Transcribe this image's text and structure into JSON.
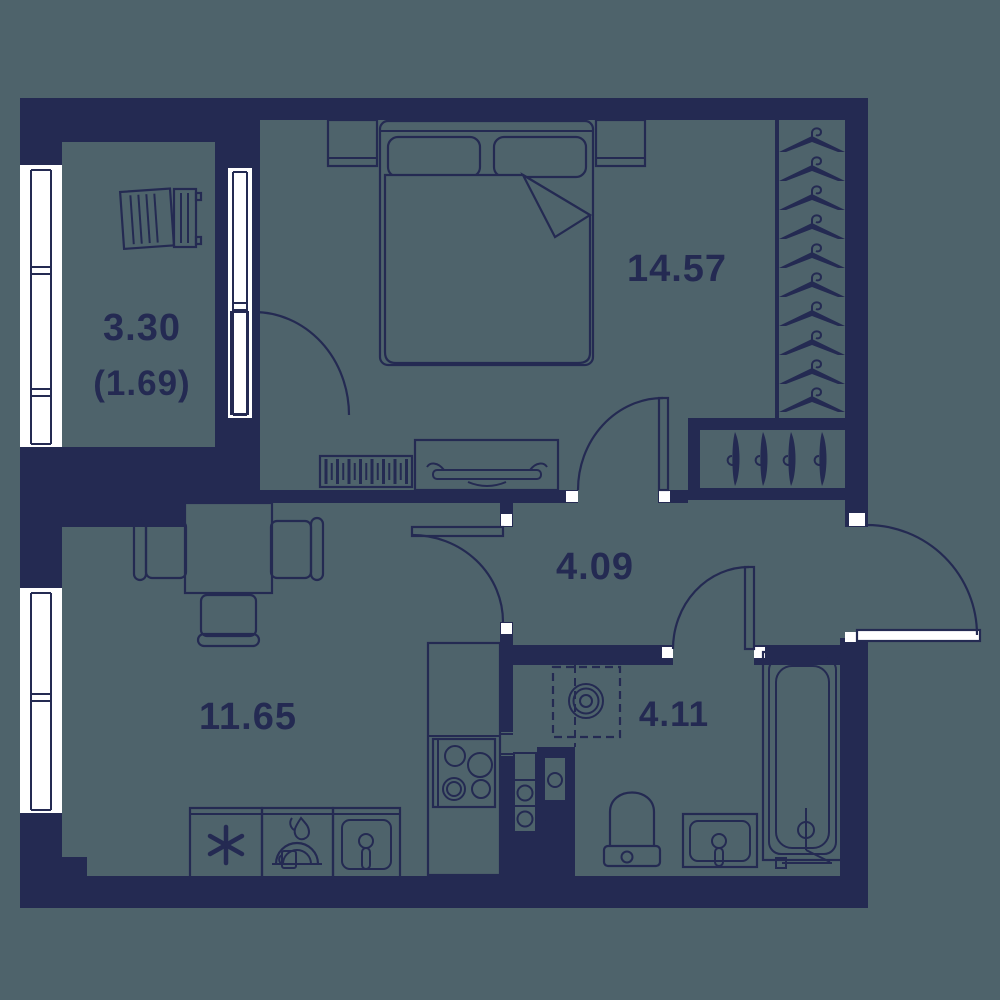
{
  "title": "apartment-floor-plan",
  "rooms": {
    "bedroom": {
      "name": "bedroom",
      "area": "14.57"
    },
    "hall": {
      "name": "hall",
      "area": "4.09"
    },
    "living_kitchen": {
      "name": "living room / kitchen",
      "area": "11.65"
    },
    "bathroom": {
      "name": "bathroom",
      "area": "4.11"
    },
    "balcony": {
      "name": "balcony",
      "area": "3.30",
      "area_secondary": "(1.69)"
    }
  },
  "furniture": {
    "wardrobe_hangers_top_count": 10,
    "closet_hangers_side_count": 4,
    "stove_burner_count": 4,
    "dining_chair_count": 3
  },
  "colors": {
    "background": "#4e636b",
    "wall": "#242a52",
    "window": "#ffffff",
    "label": "#242a52"
  }
}
